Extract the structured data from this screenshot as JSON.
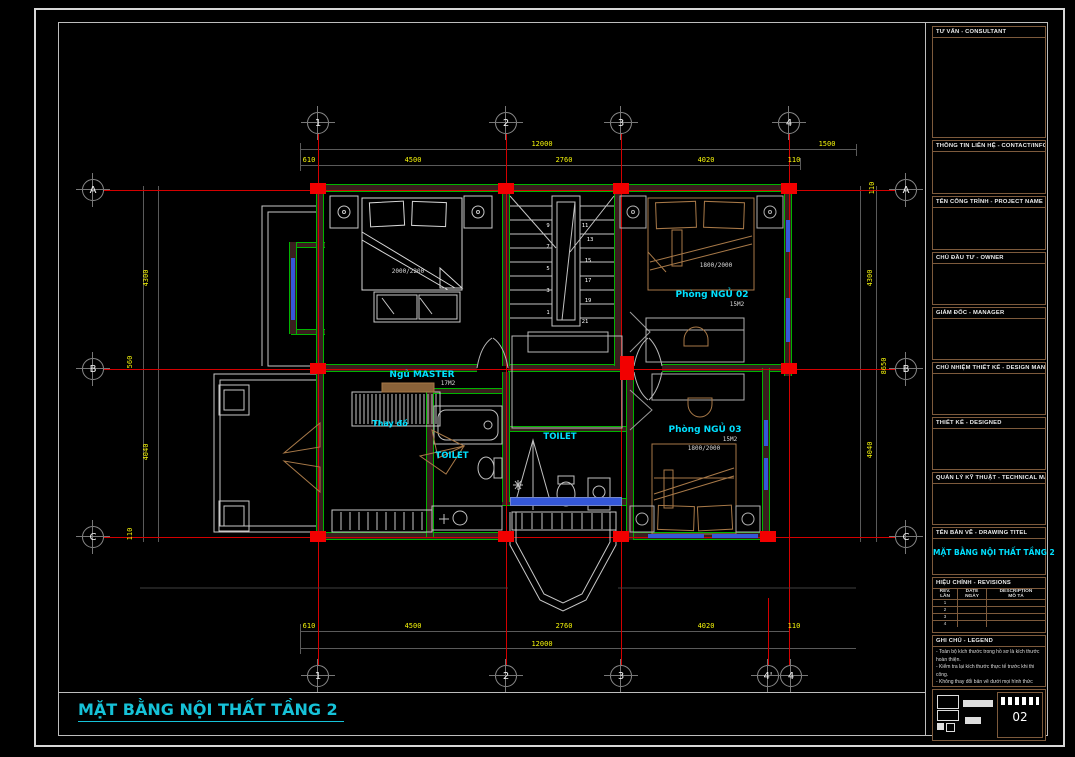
{
  "sheet": {
    "plan_title": "MẶT BẰNG NỘI THẤT TẦNG 2",
    "sheet_number": "02"
  },
  "grid": {
    "cols_top": [
      "1",
      "2",
      "3",
      "4"
    ],
    "cols_bottom": [
      "1",
      "2",
      "3",
      "4'",
      "4"
    ],
    "rows_left": [
      "A",
      "B",
      "C"
    ],
    "rows_right": [
      "A",
      "B",
      "C"
    ]
  },
  "dims": {
    "top_overall": "12000",
    "top_right": "1500",
    "top_segs": [
      "610",
      "4500",
      "2760",
      "4020",
      "110"
    ],
    "bottom_segs": [
      "610",
      "4500",
      "2760",
      "4020",
      "110"
    ],
    "bottom_overall": "12000",
    "left_segs": [
      "4300",
      "560",
      "4040",
      "110"
    ],
    "right_segs": [
      "110",
      "4300",
      "8650",
      "4040"
    ]
  },
  "rooms": {
    "bed02": {
      "label": "Phòng NGỦ 02",
      "area": "15M2",
      "bed_size": "1800/2000"
    },
    "master": {
      "label": "Ngủ MASTER",
      "area": "17M2",
      "bed_size": "2000/2200"
    },
    "bed03": {
      "label": "Phòng NGỦ 03",
      "area": "15M2",
      "bed_size": "1800/2000"
    },
    "toilet1": {
      "label": "TOILET"
    },
    "toilet2": {
      "label": "TOILET"
    },
    "dressing": {
      "label": "Thay đồ"
    }
  },
  "stairs": {
    "numbers": [
      "1",
      "3",
      "5",
      "7",
      "9",
      "11",
      "13",
      "15",
      "17",
      "19",
      "21"
    ]
  },
  "titleblock": {
    "sections": [
      {
        "label": "TƯ VẤN - CONSULTANT"
      },
      {
        "label": "THÔNG TIN LIÊN HỆ - CONTACT/INFO"
      },
      {
        "label": "TÊN CÔNG TRÌNH - PROJECT NAME"
      },
      {
        "label": "CHỦ ĐẦU TƯ - OWNER"
      },
      {
        "label": "GIÁM ĐỐC - MANAGER"
      },
      {
        "label": "CHỦ NHIỆM THIẾT KẾ - DESIGN MANAGER"
      },
      {
        "label": "THIẾT KẾ - DESIGNED"
      },
      {
        "label": "QUẢN LÝ KỸ THUẬT - TECHNICAL MANAGER"
      },
      {
        "label": "TÊN BẢN VẼ - DRAWING TITEL"
      }
    ],
    "drawing_title": "MẶT BẰNG NỘI THẤT TẦNG 2",
    "revisions": {
      "label": "HIỆU CHỈNH - REVISIONS",
      "col_rev": "REV.",
      "col_rev2": "LẦN",
      "col_date": "DATE",
      "col_date2": "NGÀY",
      "col_desc": "DESCRIPTION",
      "col_desc2": "MÔ TẢ",
      "rows": [
        "1",
        "2",
        "3",
        "4"
      ]
    },
    "legend": {
      "label": "GHI CHÚ - LEGEND",
      "notes": [
        "- Toàn bộ kích thước trong hồ sơ là kích thước hoàn thiện.",
        "- Kiểm tra lại kích thước thực tế trước khi thi công.",
        "- Không thay đổi bản vẽ dưới mọi hình thức nếu không có sự chấp thuận của đơn vị thiết kế."
      ]
    }
  },
  "colors": {
    "grid_red": "#ff2222",
    "wall_green": "#00b400",
    "wall_fill": "#3a1e1e",
    "dim_yellow": "#f5f50a",
    "label_cyan": "#00e0ff",
    "furniture_tan": "#a87948",
    "window_blue": "#3558d8",
    "titleblock_border": "#7d5a3c"
  }
}
